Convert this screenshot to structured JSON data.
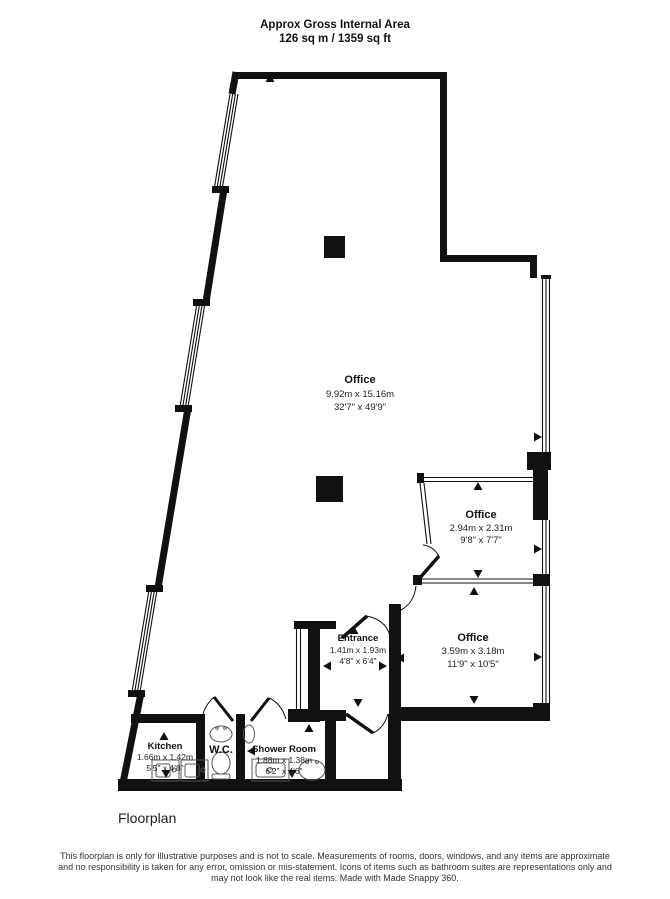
{
  "header": {
    "title": "Approx Gross Internal Area",
    "subtitle": "126 sq m / 1359 sq ft"
  },
  "rooms": {
    "office_main": {
      "name": "Office",
      "metric": "9.92m x 15.16m",
      "imperial": "32'7\" x 49'9\""
    },
    "office_small": {
      "name": "Office",
      "metric": "2.94m x 2.31m",
      "imperial": "9'8\" x 7'7\""
    },
    "office_mid": {
      "name": "Office",
      "metric": "3.59m x 3.18m",
      "imperial": "11'9\" x 10'5\""
    },
    "entrance": {
      "name": "Entrance",
      "metric": "1.41m x 1.93m",
      "imperial": "4'8\" x 6'4\""
    },
    "kitchen": {
      "name": "Kitchen",
      "metric": "1.66m x 1.42m",
      "imperial": "5'5\" x 4'8\""
    },
    "wc": {
      "name": "W.C."
    },
    "shower": {
      "name": "Shower Room",
      "metric": "1.88m x 1.38m",
      "imperial": "6'2\" x 4'6\""
    }
  },
  "footer": {
    "label": "Floorplan",
    "disclaimer_lines": [
      "This floorplan is only for illustrative purposes and is not to scale. Measurements of rooms, doors, windows, and any items are approximate",
      "and no responsibility is taken for any error, omission or mis-statement. Icons of items such as bathroom suites are representations only and",
      "may not look like the real items. Made with Made Snappy 360."
    ]
  },
  "colors": {
    "wall": "#111111",
    "text": "#1a1a1a"
  }
}
